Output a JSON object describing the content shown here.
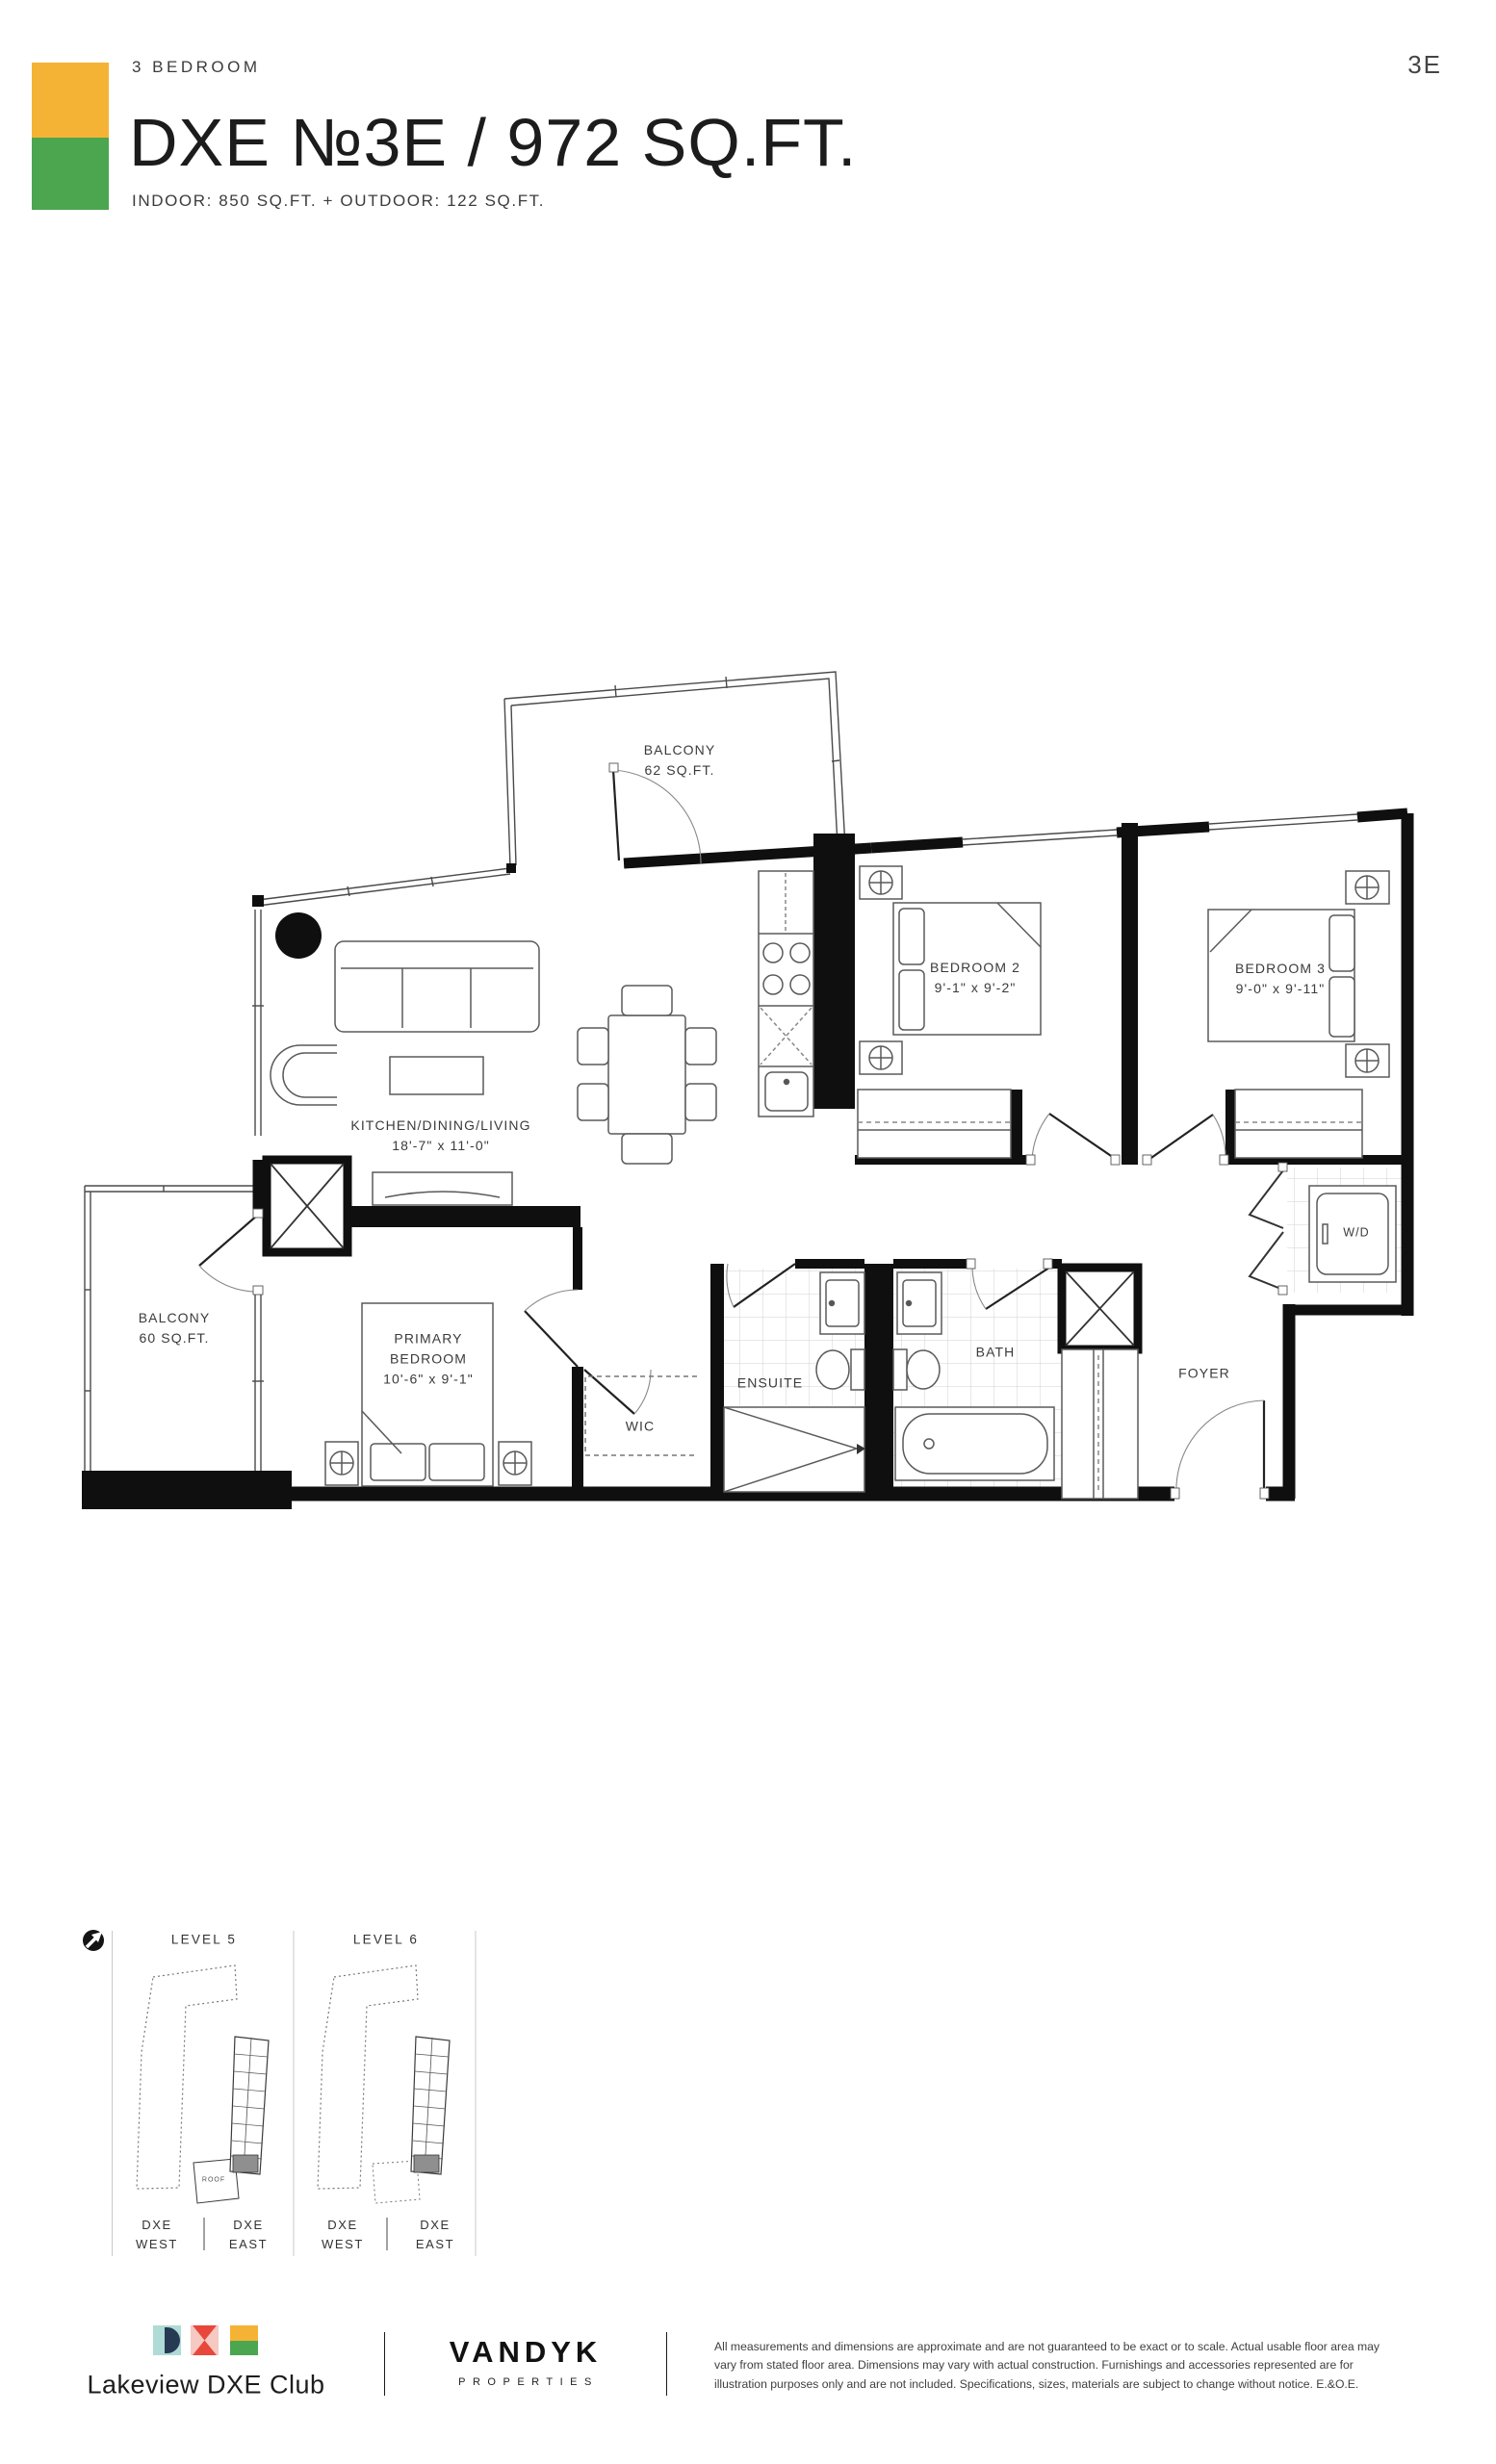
{
  "header": {
    "unit_type": "3 BEDROOM",
    "title": "DXE №3E / 972 SQ.FT.",
    "subtitle": "INDOOR: 850 SQ.FT. + OUTDOOR: 122 SQ.FT.",
    "page_ref": "3E",
    "tile_yellow": "#F5B335",
    "tile_green": "#4BA64F"
  },
  "floorplan": {
    "balcony_top": {
      "label": "BALCONY",
      "size": "62 SQ.FT."
    },
    "bedroom2": {
      "label": "BEDROOM 2",
      "size": "9'-1\" x 9'-2\""
    },
    "bedroom3": {
      "label": "BEDROOM 3",
      "size": "9'-0\" x 9'-11\""
    },
    "kitchen": {
      "label": "KITCHEN/DINING/LIVING",
      "size": "18'-7\" x 11'-0\""
    },
    "balcony_left": {
      "label": "BALCONY",
      "size": "60 SQ.FT."
    },
    "primary": {
      "label": "PRIMARY",
      "label2": "BEDROOM",
      "size": "10'-6\" x 9'-1\""
    },
    "wic": {
      "label": "WIC"
    },
    "ensuite": {
      "label": "ENSUITE"
    },
    "bath": {
      "label": "BATH"
    },
    "foyer": {
      "label": "FOYER"
    },
    "laundry": {
      "label": "W/D"
    }
  },
  "keyplans": {
    "level5": {
      "title": "LEVEL 5",
      "roof_label": "ROOF",
      "west_line1": "DXE",
      "west_line2": "WEST",
      "east_line1": "DXE",
      "east_line2": "EAST"
    },
    "level6": {
      "title": "LEVEL 6",
      "west_line1": "DXE",
      "west_line2": "WEST",
      "east_line1": "DXE",
      "east_line2": "EAST"
    },
    "highlight_color": "#8F8F8F"
  },
  "footer": {
    "brand_name": "Lakeview DXE Club",
    "developer_name": "VANDYK",
    "developer_subtitle": "PROPERTIES",
    "disclaimer": "All measurements and dimensions are approximate and are not guaranteed to be exact or to scale. Actual usable floor area may vary from stated floor area. Dimensions may vary with actual construction. Furnishings and accessories represented are for illustration purposes only and are not included. Specifications, sizes, materials are subject to change without notice. E.&O.E.",
    "logo_teal": "#AFDBD6",
    "logo_navy": "#273A53",
    "logo_pink": "#F6C9C2",
    "logo_red": "#E8473C",
    "logo_yellow": "#F5B335",
    "logo_green": "#4BA64F"
  }
}
